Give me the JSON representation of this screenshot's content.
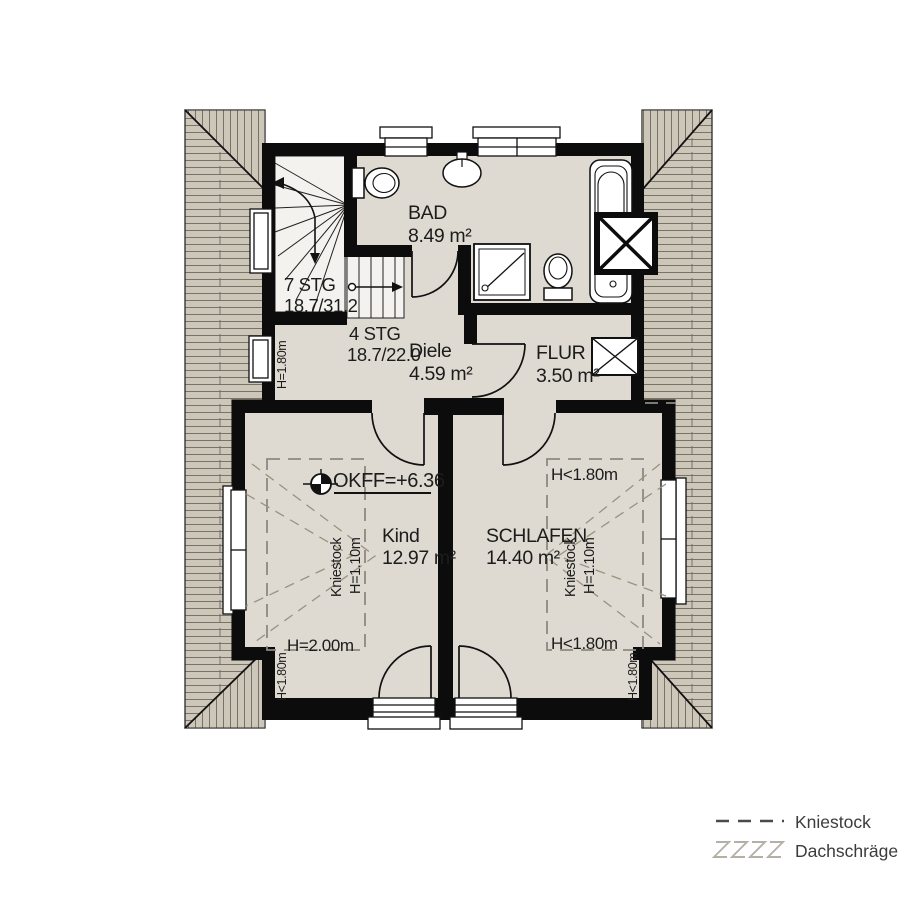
{
  "rooms": {
    "bad": {
      "name": "BAD",
      "area": "8.49 m²"
    },
    "diele": {
      "name": "Diele",
      "area": "4.59 m²"
    },
    "flur": {
      "name": "FLUR",
      "area": "3.50 m²"
    },
    "kind": {
      "name": "Kind",
      "area": "12.97 m²"
    },
    "schlafen": {
      "name": "SCHLAFEN",
      "area": "14.40 m²"
    }
  },
  "stairs": {
    "upper": {
      "label": "7 STG",
      "dimensions": "18.7/31.2"
    },
    "lower": {
      "label": "4 STG",
      "dimensions": "18.7/22.0"
    }
  },
  "annotations": {
    "level": "OKFF=+6.36",
    "kniestock_label": "Kniestock",
    "kniestock_height": "H=1.10m",
    "height_200": "H=2.00m",
    "height_lt_180": "H<1.80m",
    "height_eq_180": "H=1.80m"
  },
  "legend": {
    "kniestock": "Kniestock",
    "dachschraege": "Dachschräge"
  },
  "colors": {
    "floor": "#dfdad1",
    "roof_hatch": "#ccc7b9",
    "wall": "#0c0c0c",
    "dashed_annotation": "#8e897d"
  }
}
